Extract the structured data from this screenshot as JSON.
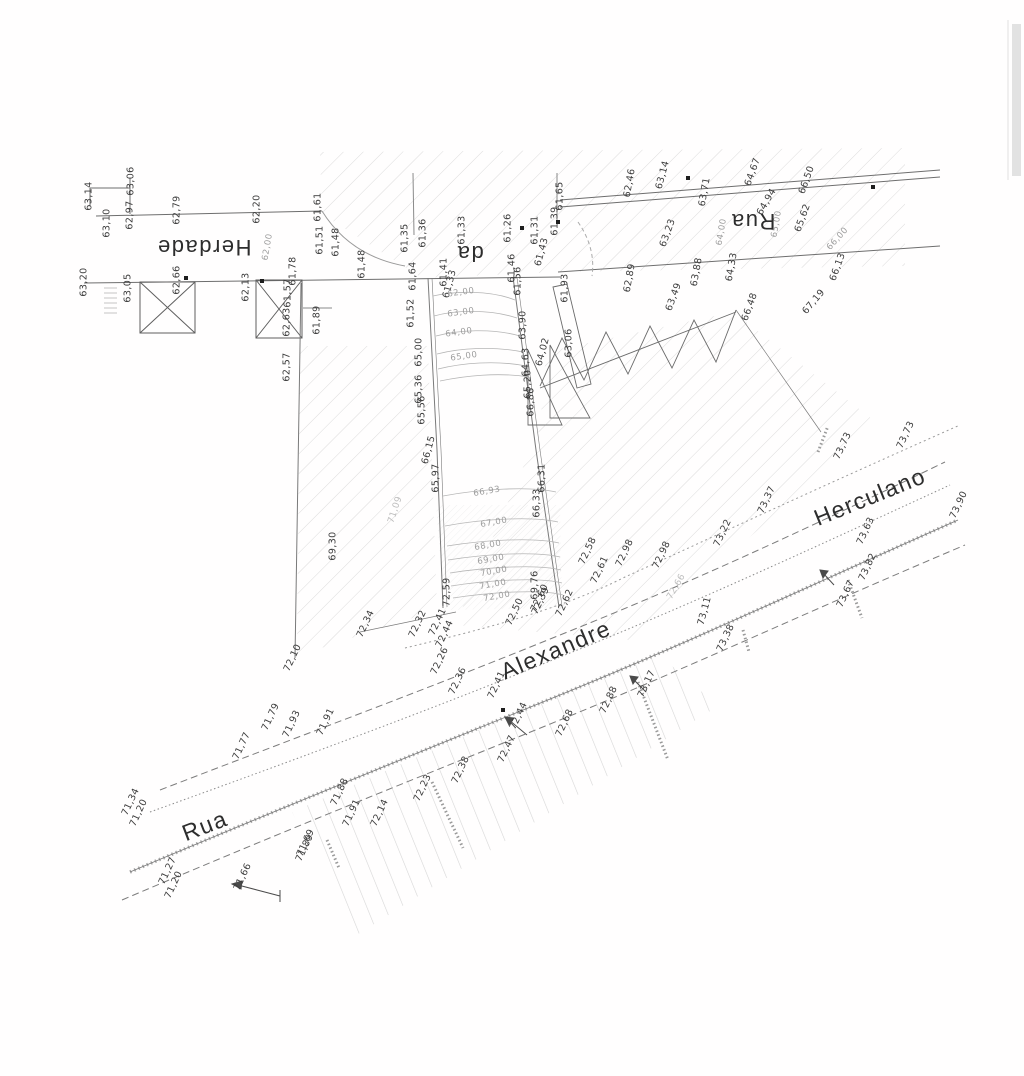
{
  "map": {
    "type": "topographic-survey-plan",
    "streets": [
      "Rua da Herdade",
      "Rua Alexandre Herculano"
    ],
    "street_labels": [
      {
        "text": "Herdade",
        "x": 204,
        "y": 247,
        "r": 180,
        "size": 22
      },
      {
        "text": "da",
        "x": 470,
        "y": 253,
        "r": 180,
        "size": 22
      },
      {
        "text": "Rua",
        "x": 753,
        "y": 221,
        "r": 180,
        "size": 22
      },
      {
        "text": "Rua",
        "x": 205,
        "y": 826,
        "r": -21,
        "size": 23
      },
      {
        "text": "Alexandre",
        "x": 556,
        "y": 650,
        "r": -23,
        "size": 23
      },
      {
        "text": "Herculano",
        "x": 870,
        "y": 497,
        "r": -22,
        "size": 23
      }
    ],
    "spot_elevations": [
      {
        "t": "63,14",
        "x": 89,
        "y": 196,
        "r": -90
      },
      {
        "t": "63,10",
        "x": 107,
        "y": 223,
        "r": -90
      },
      {
        "t": "63,06",
        "x": 131,
        "y": 181,
        "r": -90
      },
      {
        "t": "62,97",
        "x": 130,
        "y": 215,
        "r": -90
      },
      {
        "t": "62,79",
        "x": 177,
        "y": 210,
        "r": -90
      },
      {
        "t": "62,20",
        "x": 257,
        "y": 209,
        "r": -90
      },
      {
        "t": "61,61",
        "x": 318,
        "y": 207,
        "r": -90
      },
      {
        "t": "61,51",
        "x": 320,
        "y": 240,
        "r": -90
      },
      {
        "t": "61,48",
        "x": 336,
        "y": 242,
        "r": -90
      },
      {
        "t": "61,48",
        "x": 362,
        "y": 264,
        "r": -90
      },
      {
        "t": "63,20",
        "x": 84,
        "y": 282,
        "r": -90
      },
      {
        "t": "63,05",
        "x": 128,
        "y": 288,
        "r": -90
      },
      {
        "t": "62,66",
        "x": 177,
        "y": 280,
        "r": -90
      },
      {
        "t": "62,13",
        "x": 246,
        "y": 287,
        "r": -90
      },
      {
        "t": "61,78",
        "x": 293,
        "y": 271,
        "r": -90
      },
      {
        "t": "61,57",
        "x": 288,
        "y": 293,
        "r": -90
      },
      {
        "t": "61,89",
        "x": 317,
        "y": 320,
        "r": -90
      },
      {
        "t": "62,63",
        "x": 287,
        "y": 322,
        "r": -90
      },
      {
        "t": "62,57",
        "x": 287,
        "y": 367,
        "r": -90
      },
      {
        "t": "61,52",
        "x": 411,
        "y": 313,
        "r": -90
      },
      {
        "t": "61,64",
        "x": 413,
        "y": 276,
        "r": -90
      },
      {
        "t": "61,41",
        "x": 444,
        "y": 272,
        "r": -90
      },
      {
        "t": "61,33",
        "x": 450,
        "y": 284,
        "r": -75
      },
      {
        "t": "61,35",
        "x": 405,
        "y": 238,
        "r": -90
      },
      {
        "t": "61,36",
        "x": 423,
        "y": 233,
        "r": -90
      },
      {
        "t": "61,33",
        "x": 462,
        "y": 230,
        "r": -90
      },
      {
        "t": "61,26",
        "x": 508,
        "y": 228,
        "r": -90
      },
      {
        "t": "61,31",
        "x": 535,
        "y": 230,
        "r": -90
      },
      {
        "t": "61,43",
        "x": 542,
        "y": 252,
        "r": -75
      },
      {
        "t": "61,46",
        "x": 512,
        "y": 268,
        "r": -90
      },
      {
        "t": "61,56",
        "x": 518,
        "y": 281,
        "r": -90
      },
      {
        "t": "61,65",
        "x": 560,
        "y": 196,
        "r": -90
      },
      {
        "t": "61,39",
        "x": 555,
        "y": 221,
        "r": -90
      },
      {
        "t": "61,93",
        "x": 565,
        "y": 288,
        "r": -90
      },
      {
        "t": "62,46",
        "x": 630,
        "y": 183,
        "r": -80
      },
      {
        "t": "63,14",
        "x": 663,
        "y": 175,
        "r": -75
      },
      {
        "t": "63,71",
        "x": 705,
        "y": 192,
        "r": -80
      },
      {
        "t": "64,67",
        "x": 753,
        "y": 172,
        "r": -70
      },
      {
        "t": "66,50",
        "x": 807,
        "y": 180,
        "r": -70
      },
      {
        "t": "64,94",
        "x": 767,
        "y": 202,
        "r": -60
      },
      {
        "t": "65,62",
        "x": 803,
        "y": 218,
        "r": -70
      },
      {
        "t": "63,23",
        "x": 668,
        "y": 233,
        "r": -70
      },
      {
        "t": "62,89",
        "x": 630,
        "y": 278,
        "r": -80
      },
      {
        "t": "63,88",
        "x": 697,
        "y": 272,
        "r": -80
      },
      {
        "t": "64,33",
        "x": 732,
        "y": 267,
        "r": -80
      },
      {
        "t": "66,13",
        "x": 838,
        "y": 267,
        "r": -70
      },
      {
        "t": "66,48",
        "x": 750,
        "y": 307,
        "r": -70
      },
      {
        "t": "67,19",
        "x": 814,
        "y": 302,
        "r": -50
      },
      {
        "t": "63,49",
        "x": 674,
        "y": 297,
        "r": -70
      },
      {
        "t": "63,06",
        "x": 569,
        "y": 343,
        "r": -90
      },
      {
        "t": "64,02",
        "x": 543,
        "y": 352,
        "r": -75
      },
      {
        "t": "63,90",
        "x": 523,
        "y": 325,
        "r": -90
      },
      {
        "t": "64,63",
        "x": 526,
        "y": 362,
        "r": -90
      },
      {
        "t": "65,20",
        "x": 528,
        "y": 384,
        "r": -90
      },
      {
        "t": "66,86",
        "x": 531,
        "y": 402,
        "r": -90
      },
      {
        "t": "65,00",
        "x": 419,
        "y": 352,
        "r": -90
      },
      {
        "t": "65,36",
        "x": 419,
        "y": 389,
        "r": -90
      },
      {
        "t": "65,56",
        "x": 422,
        "y": 410,
        "r": -90
      },
      {
        "t": "66,15",
        "x": 429,
        "y": 450,
        "r": -75
      },
      {
        "t": "65,97",
        "x": 436,
        "y": 478,
        "r": -90
      },
      {
        "t": "69,30",
        "x": 333,
        "y": 546,
        "r": -90
      },
      {
        "t": "66,31",
        "x": 542,
        "y": 478,
        "r": -90
      },
      {
        "t": "66,33",
        "x": 537,
        "y": 503,
        "r": -90
      },
      {
        "t": "69,76",
        "x": 535,
        "y": 585,
        "r": -90
      },
      {
        "t": "72,39",
        "x": 541,
        "y": 601,
        "r": -65
      },
      {
        "t": "72,10",
        "x": 293,
        "y": 658,
        "r": -65
      },
      {
        "t": "72,34",
        "x": 366,
        "y": 624,
        "r": -65
      },
      {
        "t": "72,32",
        "x": 418,
        "y": 624,
        "r": -65
      },
      {
        "t": "72,41",
        "x": 438,
        "y": 622,
        "r": -65
      },
      {
        "t": "72,59",
        "x": 447,
        "y": 592,
        "r": -90
      },
      {
        "t": "72,44",
        "x": 445,
        "y": 634,
        "r": -65
      },
      {
        "t": "72,26",
        "x": 440,
        "y": 661,
        "r": -65
      },
      {
        "t": "72,36",
        "x": 458,
        "y": 681,
        "r": -65
      },
      {
        "t": "72,41",
        "x": 497,
        "y": 685,
        "r": -65
      },
      {
        "t": "72,44",
        "x": 519,
        "y": 716,
        "r": -65
      },
      {
        "t": "72,47",
        "x": 507,
        "y": 749,
        "r": -65
      },
      {
        "t": "72,50",
        "x": 515,
        "y": 612,
        "r": -65
      },
      {
        "t": "72,60",
        "x": 540,
        "y": 598,
        "r": -65
      },
      {
        "t": "72,62",
        "x": 565,
        "y": 603,
        "r": -65
      },
      {
        "t": "72,61",
        "x": 600,
        "y": 570,
        "r": -65
      },
      {
        "t": "72,58",
        "x": 588,
        "y": 551,
        "r": -65
      },
      {
        "t": "72,68",
        "x": 565,
        "y": 723,
        "r": -65
      },
      {
        "t": "72,88",
        "x": 609,
        "y": 700,
        "r": -65
      },
      {
        "t": "73,17",
        "x": 647,
        "y": 684,
        "r": -65
      },
      {
        "t": "72,98",
        "x": 625,
        "y": 553,
        "r": -65
      },
      {
        "t": "72,98",
        "x": 662,
        "y": 555,
        "r": -65
      },
      {
        "t": "73,22",
        "x": 723,
        "y": 533,
        "r": -65
      },
      {
        "t": "73,11",
        "x": 705,
        "y": 611,
        "r": -75
      },
      {
        "t": "73,38",
        "x": 726,
        "y": 638,
        "r": -65
      },
      {
        "t": "73,37",
        "x": 767,
        "y": 500,
        "r": -65
      },
      {
        "t": "73,73",
        "x": 843,
        "y": 446,
        "r": -65
      },
      {
        "t": "73,73",
        "x": 906,
        "y": 435,
        "r": -65
      },
      {
        "t": "73,63",
        "x": 866,
        "y": 531,
        "r": -65
      },
      {
        "t": "73,90",
        "x": 959,
        "y": 505,
        "r": -65
      },
      {
        "t": "73,82",
        "x": 868,
        "y": 567,
        "r": -65
      },
      {
        "t": "73,67",
        "x": 846,
        "y": 594,
        "r": -65
      },
      {
        "t": "71,77",
        "x": 242,
        "y": 746,
        "r": -65
      },
      {
        "t": "71,79",
        "x": 271,
        "y": 717,
        "r": -65
      },
      {
        "t": "71,93",
        "x": 292,
        "y": 724,
        "r": -65
      },
      {
        "t": "71,91",
        "x": 326,
        "y": 722,
        "r": -65
      },
      {
        "t": "71,34",
        "x": 131,
        "y": 802,
        "r": -65
      },
      {
        "t": "71,20",
        "x": 139,
        "y": 813,
        "r": -65
      },
      {
        "t": "71,27",
        "x": 168,
        "y": 871,
        "r": -65
      },
      {
        "t": "71,20",
        "x": 174,
        "y": 885,
        "r": -65
      },
      {
        "t": "71,66",
        "x": 243,
        "y": 877,
        "r": -65
      },
      {
        "t": "71,89",
        "x": 305,
        "y": 848,
        "r": -65
      },
      {
        "t": "71,88",
        "x": 340,
        "y": 792,
        "r": -65
      },
      {
        "t": "71,91",
        "x": 352,
        "y": 813,
        "r": -65
      },
      {
        "t": "71,69",
        "x": 306,
        "y": 843,
        "r": -65
      },
      {
        "t": "72,14",
        "x": 380,
        "y": 813,
        "r": -65
      },
      {
        "t": "72,23",
        "x": 423,
        "y": 788,
        "r": -65
      },
      {
        "t": "72,38",
        "x": 461,
        "y": 770,
        "r": -65
      }
    ],
    "contour_labels": [
      {
        "t": "62,00",
        "x": 461,
        "y": 293,
        "r": -8
      },
      {
        "t": "63,00",
        "x": 461,
        "y": 313,
        "r": -8
      },
      {
        "t": "64,00",
        "x": 459,
        "y": 333,
        "r": -8
      },
      {
        "t": "65,00",
        "x": 464,
        "y": 357,
        "r": -8
      },
      {
        "t": "66,93",
        "x": 487,
        "y": 492,
        "r": -10
      },
      {
        "t": "67,00",
        "x": 494,
        "y": 523,
        "r": -10
      },
      {
        "t": "68,00",
        "x": 488,
        "y": 546,
        "r": -10
      },
      {
        "t": "69,00",
        "x": 491,
        "y": 560,
        "r": -10
      },
      {
        "t": "70,00",
        "x": 494,
        "y": 572,
        "r": -10
      },
      {
        "t": "71,00",
        "x": 493,
        "y": 585,
        "r": -10
      },
      {
        "t": "72,00",
        "x": 497,
        "y": 597,
        "r": -10
      },
      {
        "t": "64,00",
        "x": 722,
        "y": 232,
        "r": -80
      },
      {
        "t": "65,00",
        "x": 777,
        "y": 224,
        "r": -80
      },
      {
        "t": "66,00",
        "x": 838,
        "y": 239,
        "r": -48
      },
      {
        "t": "62,00",
        "x": 268,
        "y": 247,
        "r": -80
      }
    ],
    "faint_labels": [
      {
        "t": "72,66",
        "x": 677,
        "y": 587,
        "r": -60
      },
      {
        "t": "71,09",
        "x": 396,
        "y": 510,
        "r": -72
      }
    ],
    "point_symbols": [
      {
        "x": 186,
        "y": 278
      },
      {
        "x": 262,
        "y": 281
      },
      {
        "x": 522,
        "y": 228
      },
      {
        "x": 558,
        "y": 222
      },
      {
        "x": 503,
        "y": 710
      },
      {
        "x": 688,
        "y": 178
      },
      {
        "x": 873,
        "y": 187
      }
    ],
    "colors": {
      "ink": "#3d3d3d",
      "faint_ink": "#9c9c9c",
      "hatch": "#dcdcdc",
      "paper": "#fffefe"
    }
  }
}
